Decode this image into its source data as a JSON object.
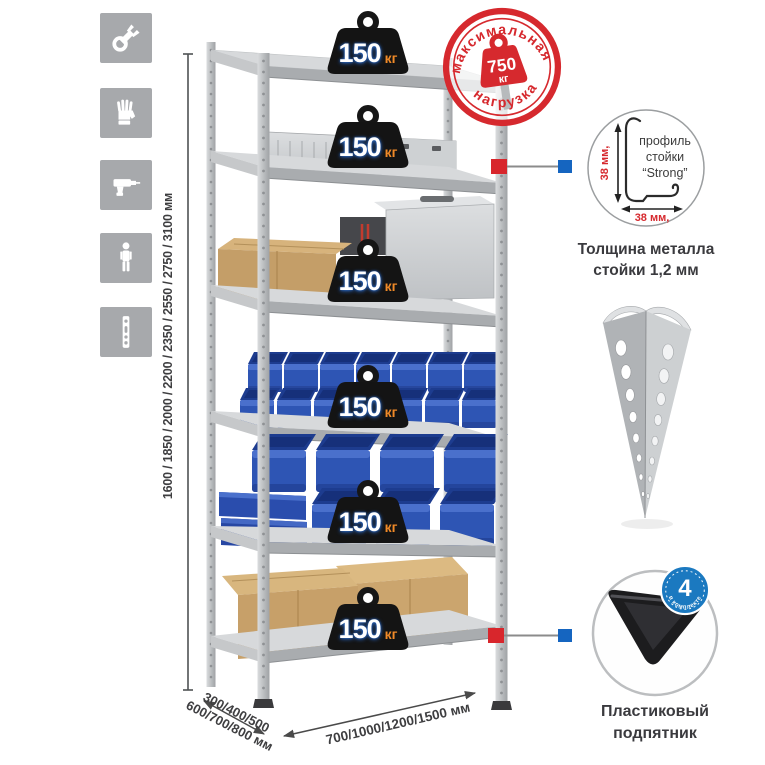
{
  "legend_icons": {
    "items": [
      {
        "name": "wrench"
      },
      {
        "name": "gloves"
      },
      {
        "name": "drill"
      },
      {
        "name": "person-height"
      },
      {
        "name": "perforated-post"
      }
    ]
  },
  "dimensions": {
    "height": "1600 / 1850 / 2000 / 2200 / 2350 / 2550 / 2750 / 3100 мм",
    "depth_line1": "300/400/500",
    "depth_line2": "600/700/800 мм",
    "width": "700/1000/1200/1500 мм"
  },
  "shelf_weights": [
    {
      "value": "150",
      "unit": "кг"
    },
    {
      "value": "150",
      "unit": "кг"
    },
    {
      "value": "150",
      "unit": "кг"
    },
    {
      "value": "150",
      "unit": "кг"
    },
    {
      "value": "150",
      "unit": "кг"
    },
    {
      "value": "150",
      "unit": "кг"
    }
  ],
  "max_load_stamp": {
    "top_text": "максимальная",
    "bottom_text": "нагрузка",
    "value": "750",
    "unit": "кг"
  },
  "profile_detail": {
    "label1": "профиль",
    "label2": "стойки",
    "label3": "“Strong”",
    "dim_v": "38 мм,",
    "dim_h": "38 мм,"
  },
  "profile_caption": {
    "line1": "Толщина металла",
    "line2": "стойки 1,2 мм"
  },
  "foot_detail": {
    "badge_value": "4",
    "badge_arc": "в комплекте",
    "caption_line1": "Пластиковый",
    "caption_line2": "подпятник"
  },
  "palette": {
    "accent_red": "#d8262c",
    "accent_blue": "#1565c0",
    "bin_blue": "#2e55b4",
    "metal_gray": "#c3c6c9",
    "icon_gray": "#a7a9ac",
    "kraft": "#c7a069",
    "weight_black": "#141414",
    "unit_orange": "#f08a28"
  }
}
